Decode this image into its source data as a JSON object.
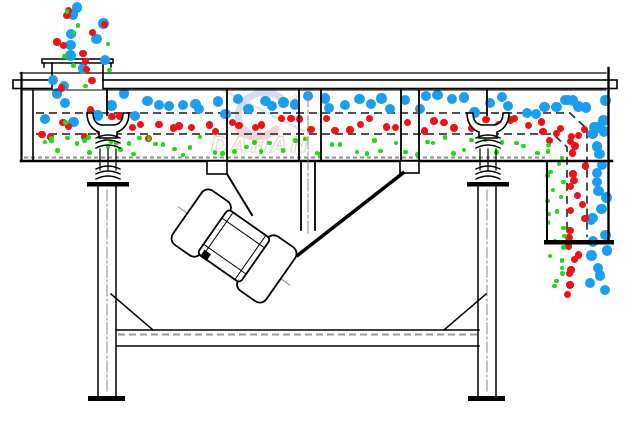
{
  "watermark": {
    "brand": "DAHAN",
    "registered": "®"
  },
  "palette": {
    "coarse_blue": "#1b9ef0",
    "medium_red": "#ee1118",
    "fine_green": "#22d818",
    "outline_black": "#000000",
    "mesh_gray": "#3a3a3a",
    "hatch_gray": "#8f8f8f",
    "centerline_gray": "#8a8a8a",
    "watermark_blue": "#b7c4e6",
    "watermark_red": "#eaacb4",
    "watermark_tail": "#c3cde8",
    "watermark_outline": "#cfc0a4",
    "watermark_reg": "#9aa4b0"
  },
  "particles": {
    "radii": {
      "coarse": 5.2,
      "medium": 3.7,
      "fine": 2.3
    },
    "streams": [
      {
        "name": "feed-coarse",
        "layer": "dots-b",
        "color": "coarse_blue",
        "size": "coarse",
        "region": [
          50,
          4,
          60,
          86
        ],
        "count": 11,
        "seed": 21
      },
      {
        "name": "feed-medium",
        "layer": "dots-b",
        "color": "medium_red",
        "size": "medium",
        "region": [
          56,
          6,
          54,
          84
        ],
        "count": 11,
        "seed": 22
      },
      {
        "name": "feed-fine",
        "layer": "dots-b",
        "color": "fine_green",
        "size": "fine",
        "region": [
          64,
          10,
          46,
          78
        ],
        "count": 8,
        "seed": 23
      },
      {
        "name": "spread-coarse",
        "layer": "dots-a",
        "color": "coarse_blue",
        "size": "coarse",
        "region": [
          38,
          92,
          112,
          32
        ],
        "count": 10,
        "seed": 31
      },
      {
        "name": "spread-medium",
        "layer": "dots-a",
        "color": "medium_red",
        "size": "medium",
        "region": [
          38,
          106,
          118,
          36
        ],
        "count": 12,
        "seed": 32
      },
      {
        "name": "spread-fine",
        "layer": "dots-a",
        "color": "fine_green",
        "size": "fine",
        "region": [
          44,
          122,
          108,
          26
        ],
        "count": 8,
        "seed": 33
      },
      {
        "name": "deck1-coarse",
        "layer": "dots-a",
        "color": "coarse_blue",
        "size": "coarse",
        "region": [
          150,
          95,
          438,
          20
        ],
        "count": 37,
        "seed": 41
      },
      {
        "name": "deck2-medium",
        "layer": "dots-a",
        "color": "medium_red",
        "size": "medium",
        "region": [
          152,
          118,
          396,
          15
        ],
        "count": 33,
        "seed": 42
      },
      {
        "name": "deck3-fine",
        "layer": "dots-a",
        "color": "fine_green",
        "size": "fine",
        "region": [
          36,
          137,
          504,
          18
        ],
        "count": 50,
        "seed": 43
      },
      {
        "name": "bend-coarse",
        "layer": "dots-a",
        "color": "coarse_blue",
        "size": "coarse",
        "region": [
          564,
          98,
          44,
          30
        ],
        "count": 7,
        "seed": 51
      },
      {
        "name": "bend-medium",
        "layer": "dots-a",
        "color": "medium_red",
        "size": "medium",
        "region": [
          540,
          122,
          46,
          22
        ],
        "count": 7,
        "seed": 52
      },
      {
        "name": "outlet-coarse",
        "layer": "dots-a",
        "color": "coarse_blue",
        "size": "coarse",
        "region": [
          588,
          116,
          22,
          180
        ],
        "count": 21,
        "seed": 61
      },
      {
        "name": "outlet-medium",
        "layer": "dots-a",
        "color": "medium_red",
        "size": "medium",
        "region": [
          567,
          136,
          19,
          160
        ],
        "count": 20,
        "seed": 62
      },
      {
        "name": "outlet-fine",
        "layer": "dots-a",
        "color": "fine_green",
        "size": "fine",
        "region": [
          547,
          143,
          18,
          145
        ],
        "count": 23,
        "seed": 63
      }
    ]
  }
}
